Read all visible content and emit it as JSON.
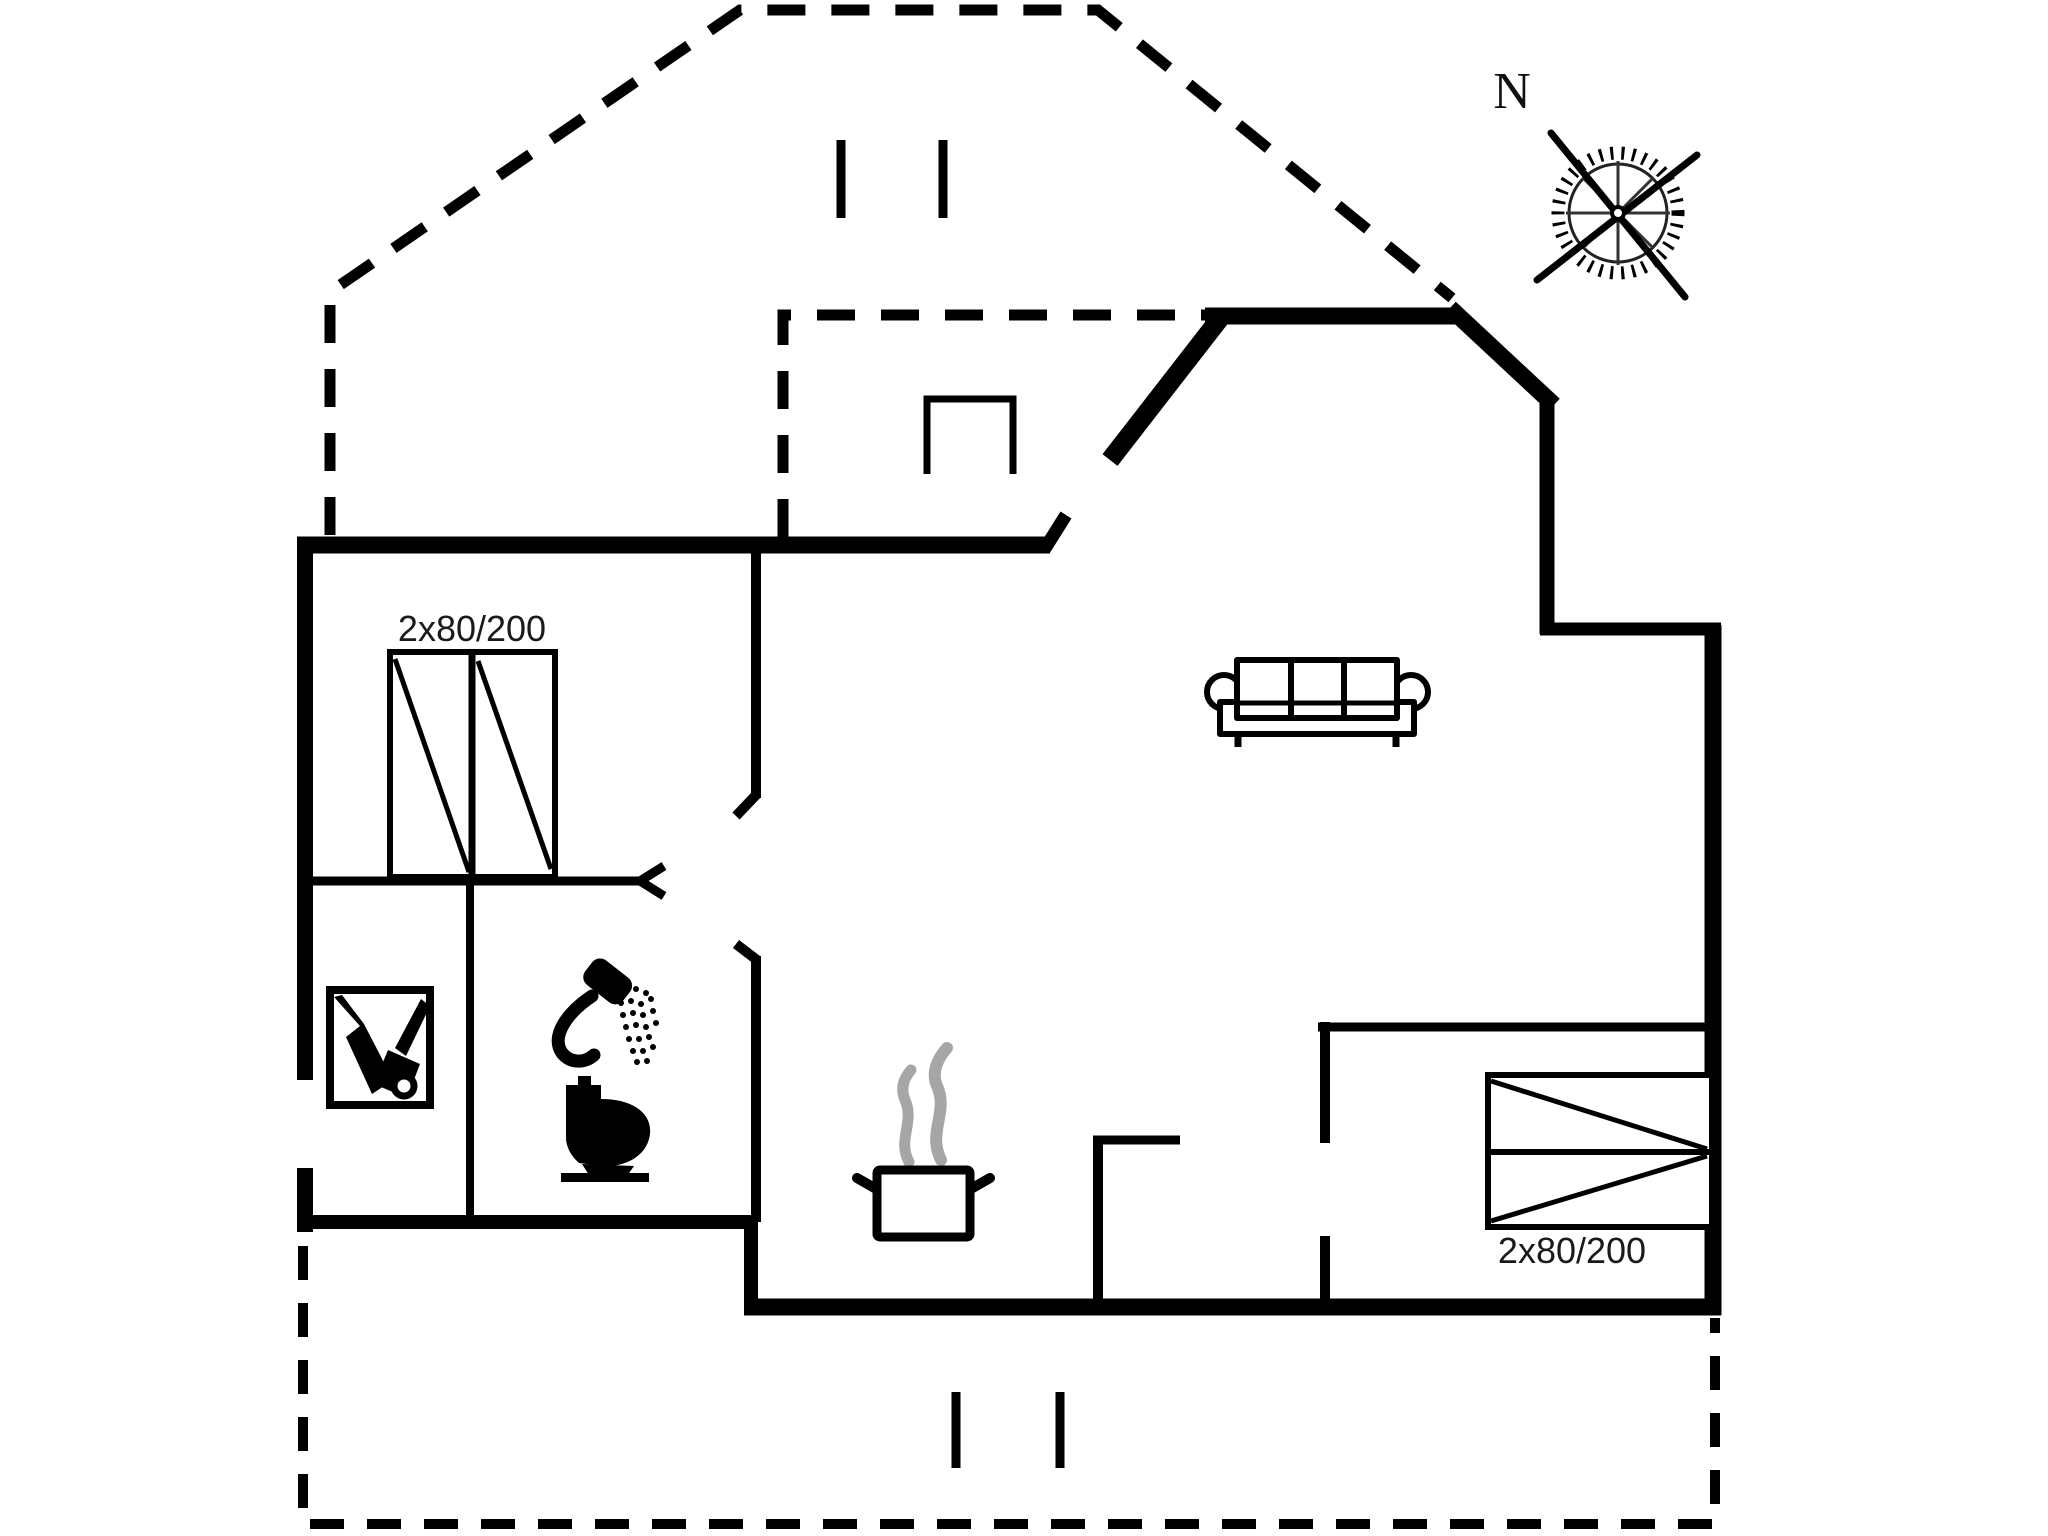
{
  "compass": {
    "label": "N"
  },
  "beds": {
    "top_left_label": "2x80/200",
    "bottom_right_label": "2x80/200"
  },
  "colors": {
    "walls": "#000000",
    "steam": "#a6a6a6",
    "text": "#1a1a1a",
    "background": "#ffffff"
  },
  "icons": {
    "compass": "compass-rose-icon",
    "bed1": "double-bed-icon",
    "bed2": "double-bed-icon",
    "sofa": "sofa-icon",
    "stove": "wood-stove-icon",
    "shower": "shower-icon",
    "toilet": "toilet-icon",
    "wardrobe": "wardrobe-icon",
    "pot": "cooking-pot-icon"
  }
}
